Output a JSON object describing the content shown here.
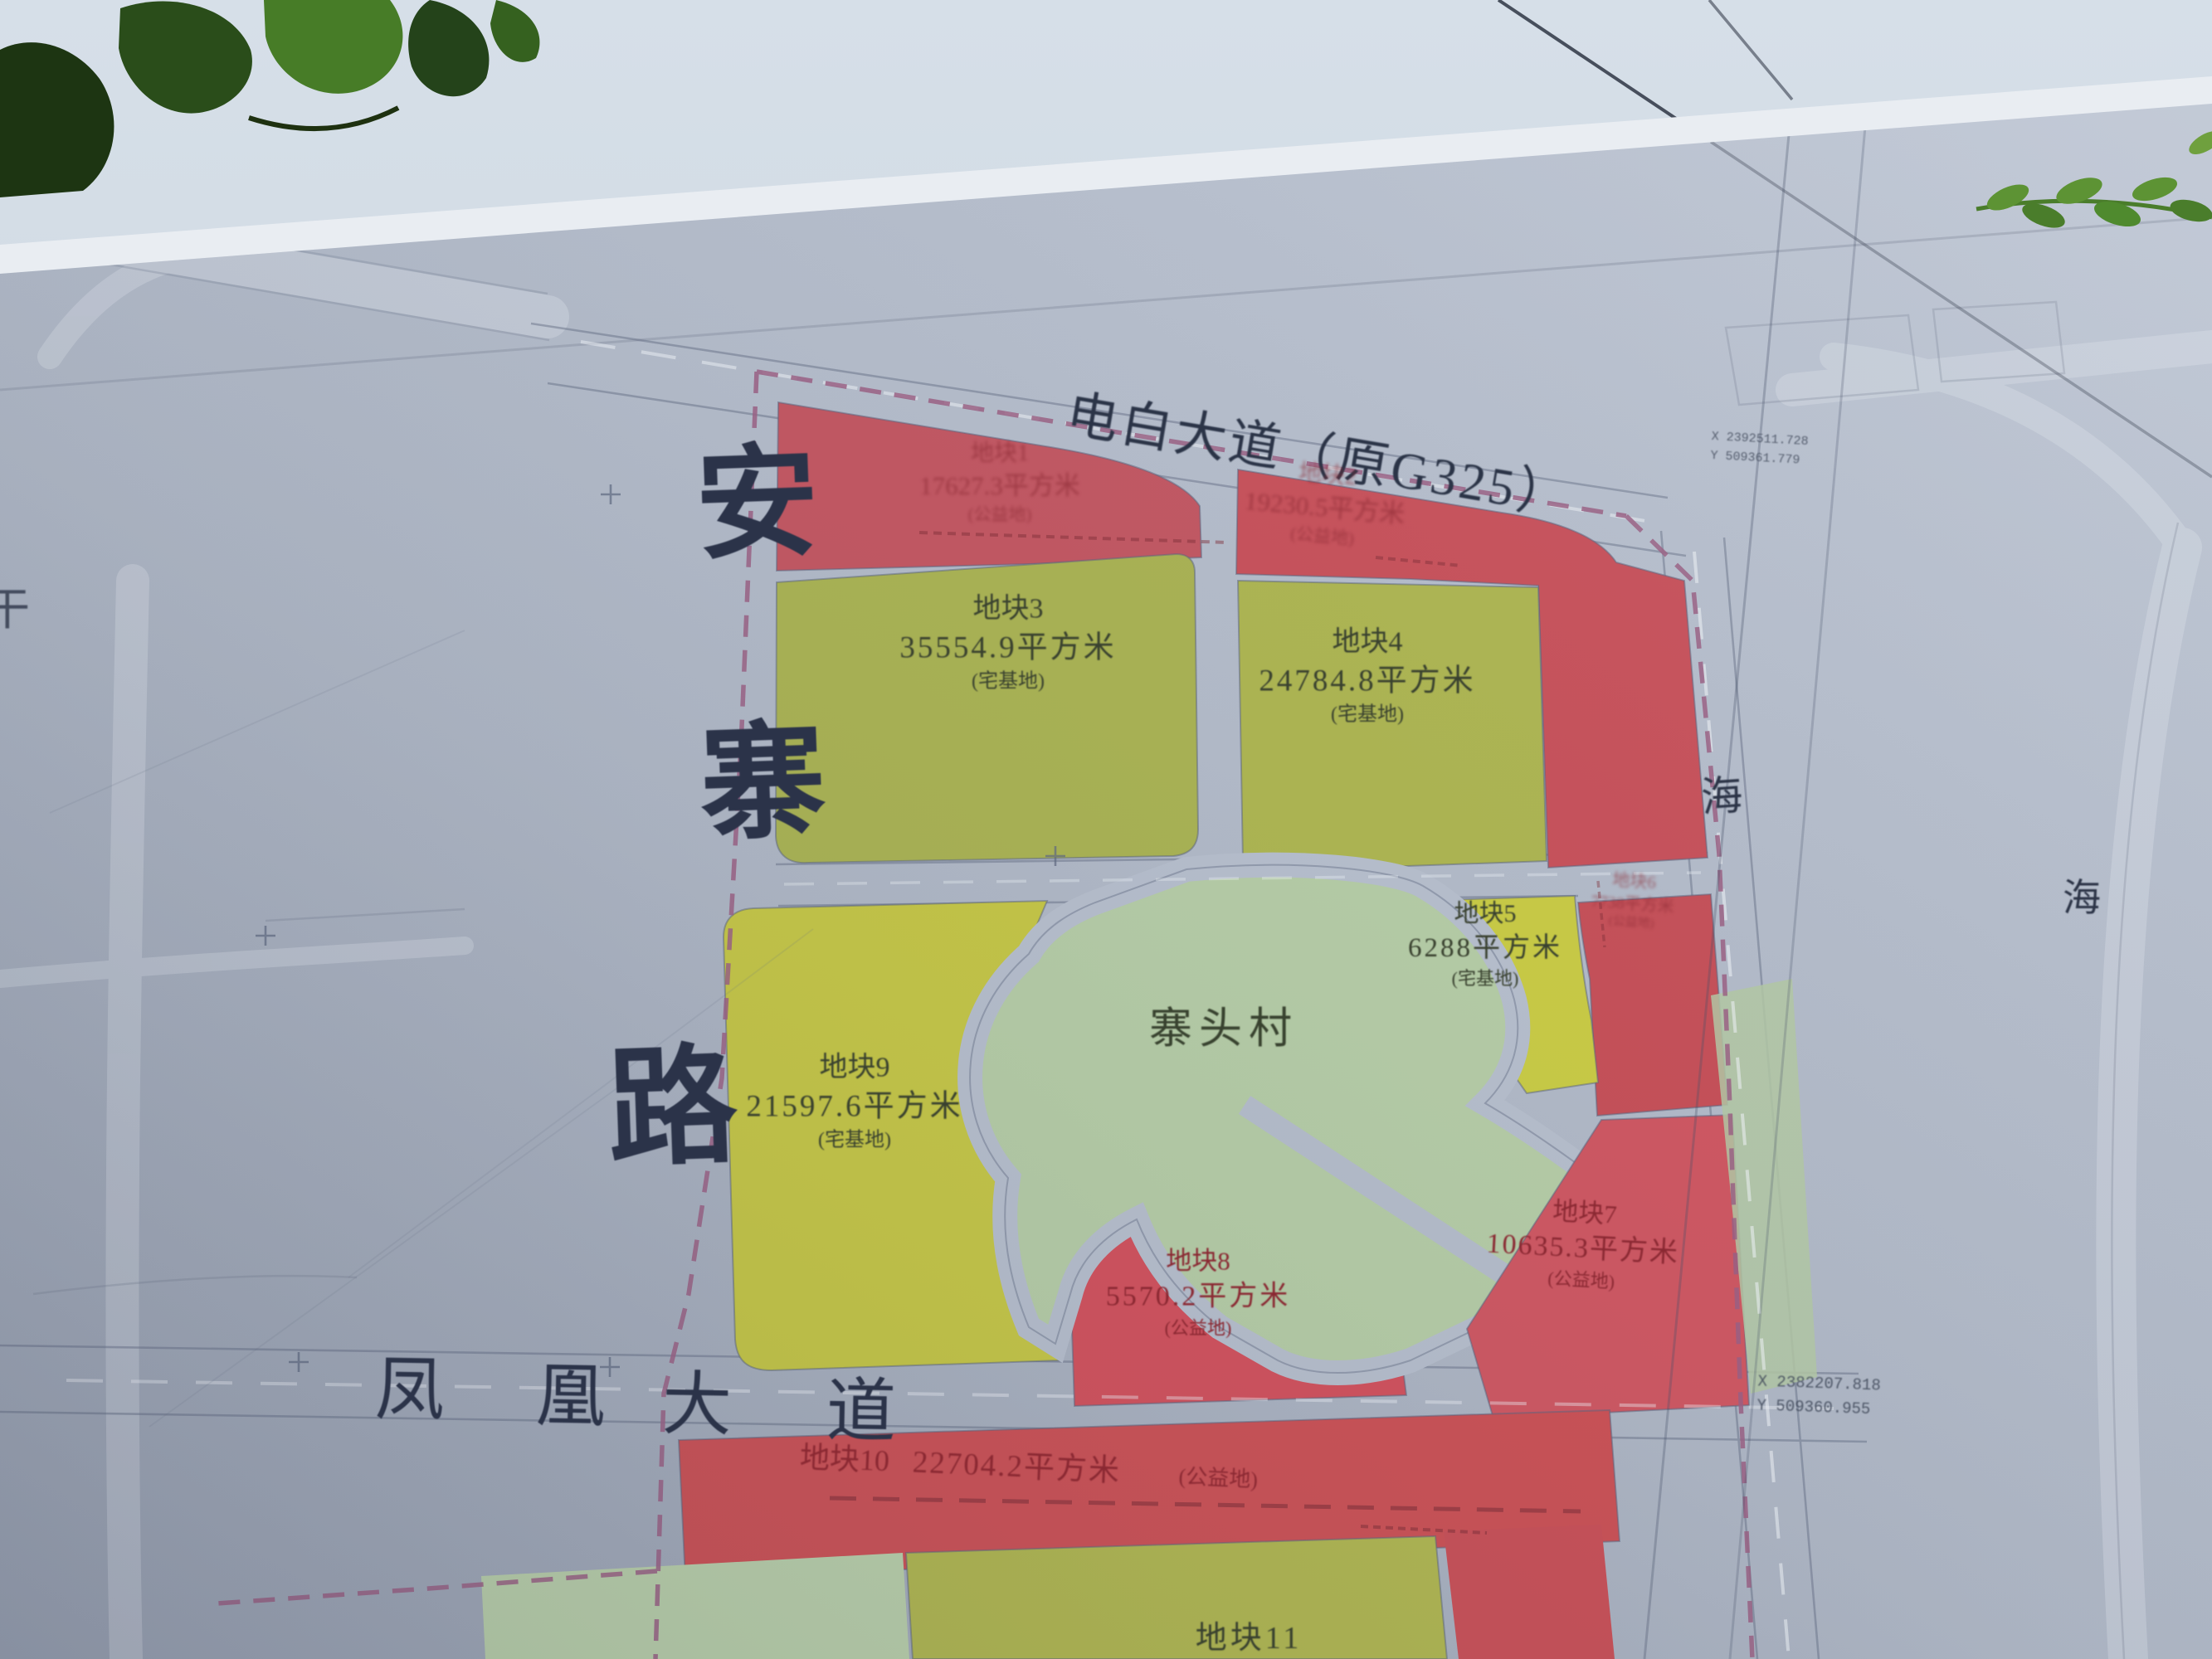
{
  "map": {
    "road_top": "电白大道（原G325）",
    "road_left_chars": [
      "安",
      "寨",
      "路"
    ],
    "road_bottom_chars": [
      "凤",
      "凰",
      "大",
      "道"
    ],
    "road_right_char_upper": "海",
    "road_right_char_outer": "海",
    "edge_char_left": "干",
    "village_name": "寨头村",
    "parcels": [
      {
        "name": "地块1",
        "area": "17627.3平方米",
        "type": "(公益地)"
      },
      {
        "name": "地块2",
        "area": "19230.5平方米",
        "type": "(公益地)"
      },
      {
        "name": "地块3",
        "area": "35554.9平方米",
        "type": "(宅基地)"
      },
      {
        "name": "地块4",
        "area": "24784.8平方米",
        "type": "(宅基地)"
      },
      {
        "name": "地块5",
        "area": "6288平方米",
        "type": "(宅基地)"
      },
      {
        "name": "地块6",
        "area": "7738平方米",
        "type": "(公益地)"
      },
      {
        "name": "地块7",
        "area": "10635.3平方米",
        "type": "(公益地)"
      },
      {
        "name": "地块8",
        "area": "5570.2平方米",
        "type": "(公益地)"
      },
      {
        "name": "地块9",
        "area": "21597.6平方米",
        "type": "(宅基地)"
      },
      {
        "name": "地块10",
        "area": "22704.2平方米",
        "type": "(公益地)"
      },
      {
        "name": "地块11",
        "area": "",
        "type": ""
      }
    ],
    "survey_labels": [
      {
        "x": "X 2392511.728",
        "y": "Y 509361.779"
      },
      {
        "x": "X 2382207.818",
        "y": "Y 509360.955"
      }
    ],
    "colors": {
      "board_grey": "#b2bac8",
      "parcel_red": "#c94e57",
      "parcel_yellow": "#bfc348",
      "parcel_olive": "#a8b250",
      "village_green": "#b5cca5",
      "boundary_purple": "#9a5f83",
      "label_maroon": "#8a2832",
      "ink_navy": "#2b3349",
      "sky": "#cdd8e2"
    }
  }
}
